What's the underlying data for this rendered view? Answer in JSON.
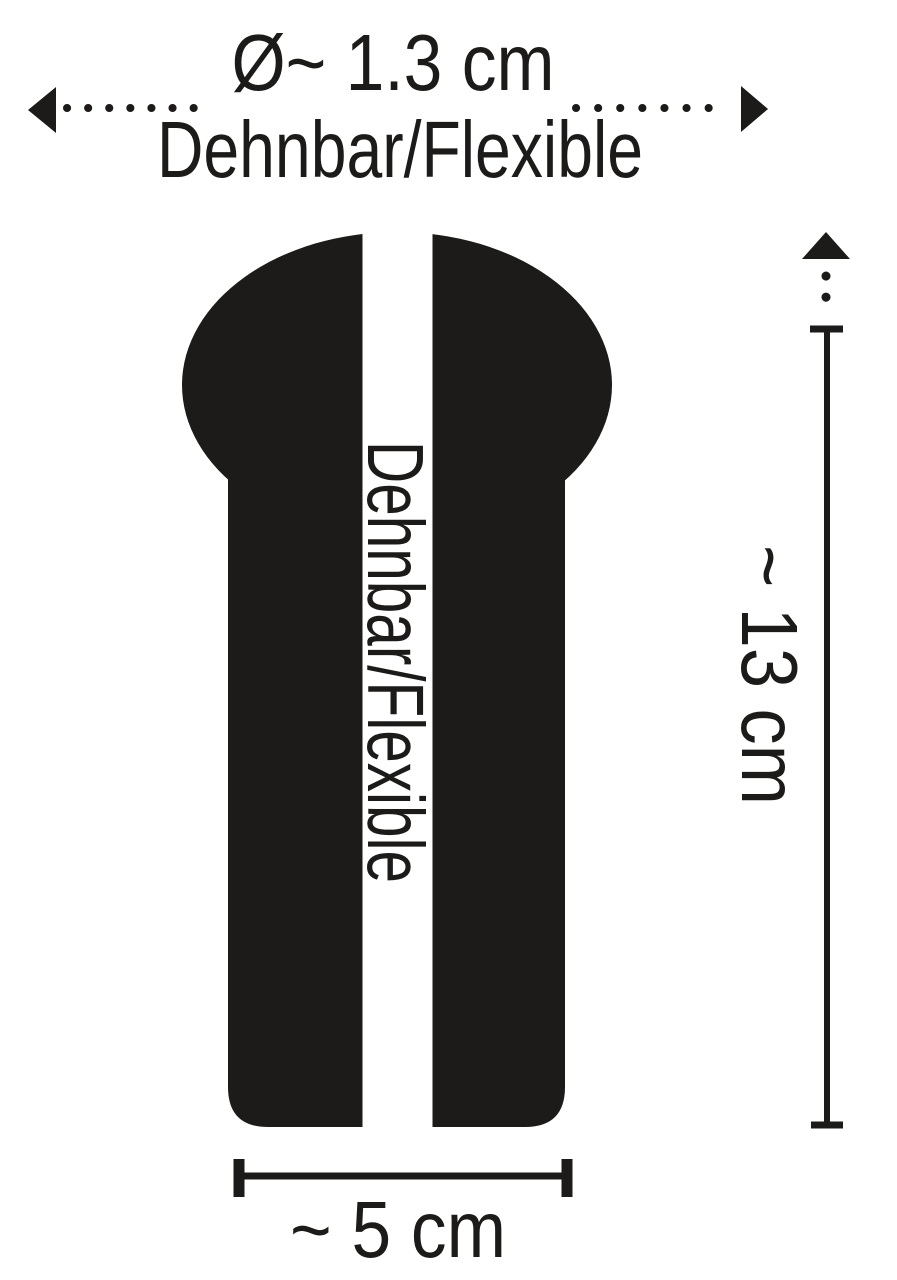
{
  "diagram": {
    "title": "Product dimension diagram",
    "colors": {
      "ink": "#1c1b19",
      "background": "#ffffff"
    },
    "top_dimension": {
      "diameter_label": "Ø~ 1.3 cm",
      "flexible_label": "Dehnbar/Flexible"
    },
    "silhouette": {
      "stripe_label": "Dehnbar/Flexible"
    },
    "length_dimension": {
      "label": "~ 13 cm"
    },
    "width_dimension": {
      "label": "~ 5 cm"
    }
  }
}
